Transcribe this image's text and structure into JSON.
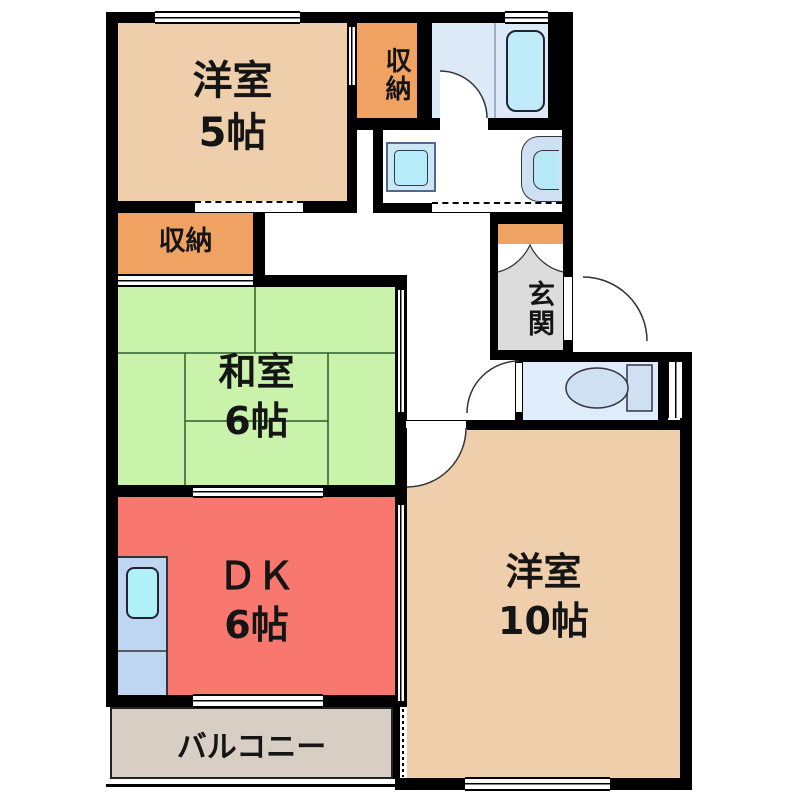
{
  "plan": {
    "rooms": {
      "western5": {
        "name": "洋室",
        "size": "5帖",
        "color": "#efcfab"
      },
      "closet_top": {
        "name": "収納",
        "color": "#f0a263"
      },
      "closet_left": {
        "name": "収納",
        "color": "#f0a263"
      },
      "japanese6": {
        "name": "和室",
        "size": "6帖",
        "color": "#c9f2aa"
      },
      "entrance": {
        "name": "玄関",
        "color": "#dcdcdc"
      },
      "dk": {
        "name": "ＤＫ",
        "size": "6帖",
        "color": "#f8786f"
      },
      "western10": {
        "name": "洋室",
        "size": "10帖",
        "color": "#efcfab"
      },
      "balcony": {
        "name": "バルコニー",
        "color": "#d8cec3"
      },
      "bathroom": {
        "color": "#dceaf8"
      },
      "washroom": {
        "color": "#ffffff"
      },
      "toilet": {
        "color": "#dfecfa"
      },
      "shoe_cabinet": {
        "color": "#f0a263"
      }
    },
    "fixtures": {
      "bathtub_color": "#c0ecfa",
      "kitchen_counter_color": "#bed6f2",
      "kitchen_sink_color": "#b0f0f8",
      "washer_pan_color": "#cbe7f3",
      "washer_drum_color": "#b6ecfa",
      "basin_color": "#cfe0f2",
      "basin_bowl_color": "#b6e8f6",
      "toilet_color": "#cfe0f2",
      "wall_color": "#000000",
      "tatami_line_color": "#2e5c2e"
    }
  }
}
